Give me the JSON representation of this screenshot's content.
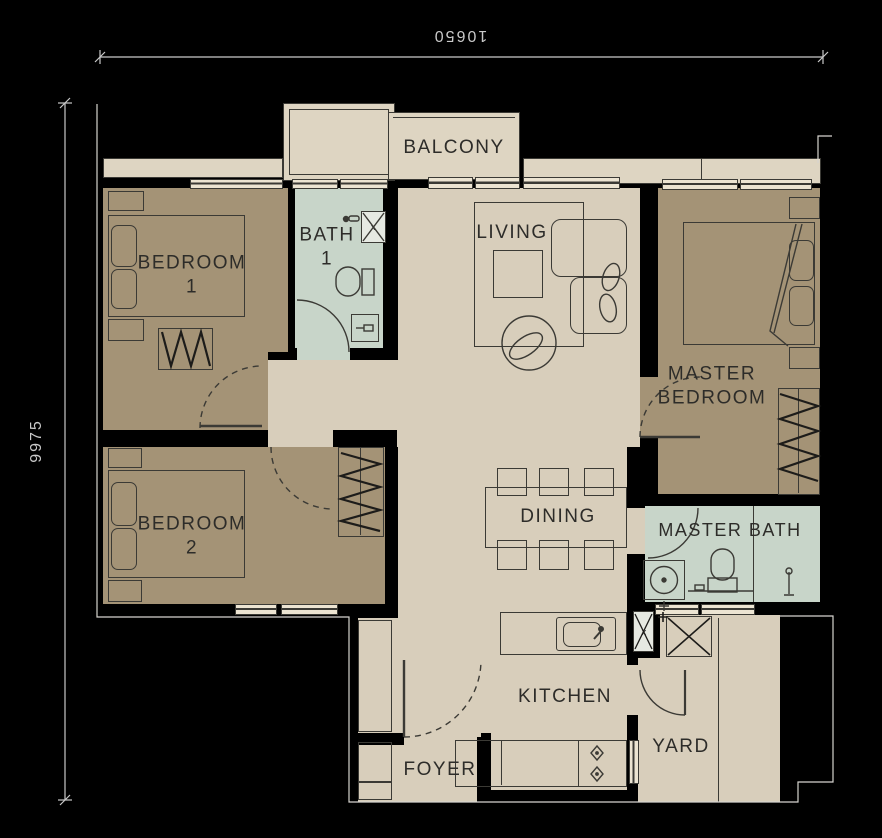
{
  "title": "apartment-floor-plan",
  "dimensions": {
    "width_label": "10650",
    "height_label": "9975"
  },
  "rooms": {
    "balcony": {
      "name": "BALCONY"
    },
    "bedroom1": {
      "name": "BEDROOM",
      "number": "1"
    },
    "bath1": {
      "name": "BATH",
      "number": "1"
    },
    "living": {
      "name": "LIVING"
    },
    "master_bedroom": {
      "line1": "MASTER",
      "line2": "BEDROOM"
    },
    "bedroom2": {
      "name": "BEDROOM",
      "number": "2"
    },
    "dining": {
      "name": "DINING"
    },
    "master_bath": {
      "name": "MASTER BATH"
    },
    "kitchen": {
      "name": "KITCHEN"
    },
    "foyer": {
      "name": "FOYER"
    },
    "yard": {
      "name": "YARD"
    }
  },
  "icons": {
    "shaft_marker": "x",
    "drain_marker": "x"
  },
  "colors": {
    "wall": "#000000",
    "bedroom_floor": "#a49376",
    "common_floor": "#d8cebb",
    "bath_floor": "#c8d5c9",
    "balcony_floor": "#ded5c2",
    "line": "#3b3a35",
    "label_text": "#2d2c29",
    "dimension_text": "#c9c9c9",
    "building_outline": "#d6d4cf"
  }
}
